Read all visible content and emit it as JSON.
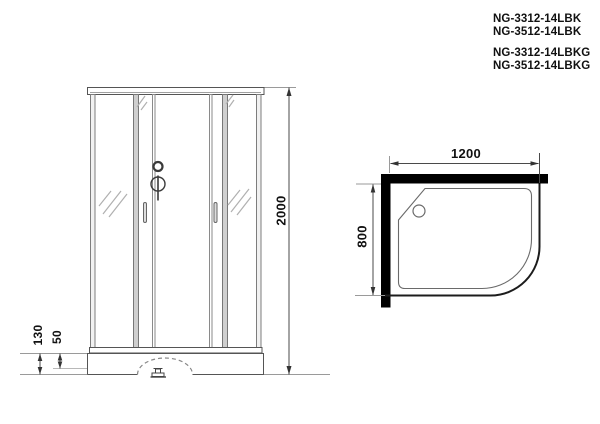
{
  "models": [
    "NG-3312-14LBK",
    "NG-3512-14LBK",
    "NG-3312-14LBKG",
    "NG-3512-14LBKG"
  ],
  "front_view": {
    "height_label": "2000",
    "tray_height_label": "130",
    "foot_height_label": "50"
  },
  "top_view": {
    "width_label": "1200",
    "depth_label": "800"
  },
  "colors": {
    "background": "#ffffff",
    "wall_fill": "#000000",
    "outline": "#3c3c3c",
    "frame_gray": "#8a8a8a",
    "dimension_line": "#4a4a4a",
    "text": "#111111"
  }
}
